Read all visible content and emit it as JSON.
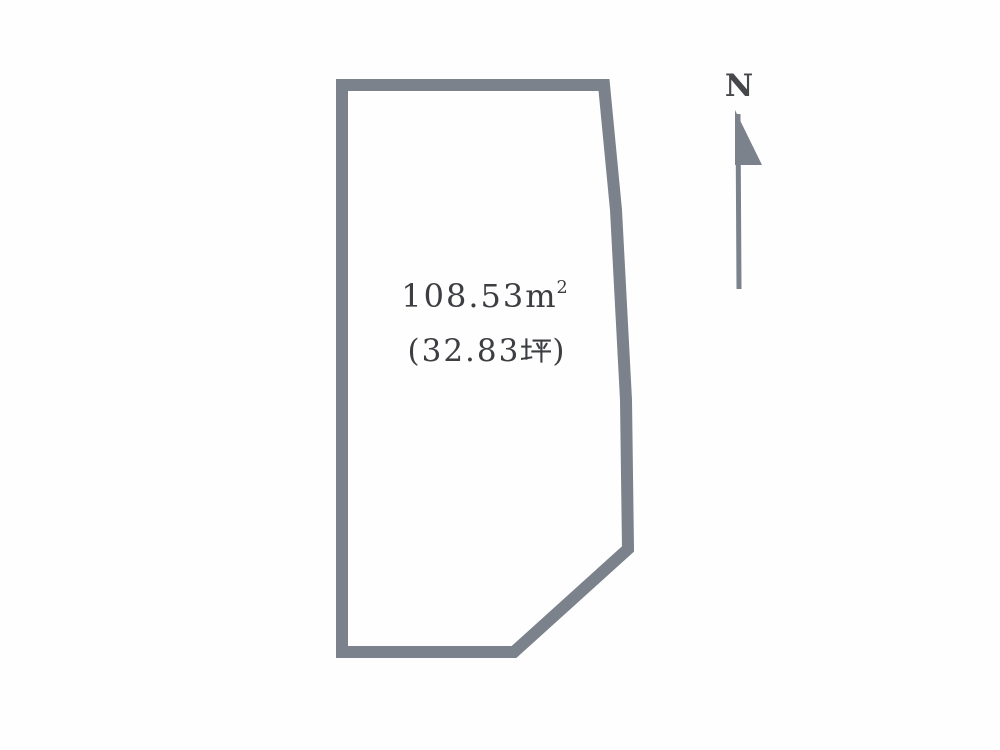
{
  "page": {
    "background": "#fefefe"
  },
  "plot": {
    "area_label": "108.53㎡",
    "area_value": "108.53",
    "area_unit_base": "m",
    "area_unit_exponent": "2",
    "tsubo_label": "(32.83坪)",
    "tsubo_open": "(32.83",
    "tsubo_unit": "坪",
    "tsubo_close": ")"
  },
  "compass": {
    "north_label": "N"
  },
  "icons": {
    "north_arrow": "north-arrow-icon",
    "tsubo_glyph": "tsubo-kanji-glyph"
  },
  "colors": {
    "outline": "#7b828b",
    "text": "#3d3e42",
    "north_text": "#46474b"
  }
}
